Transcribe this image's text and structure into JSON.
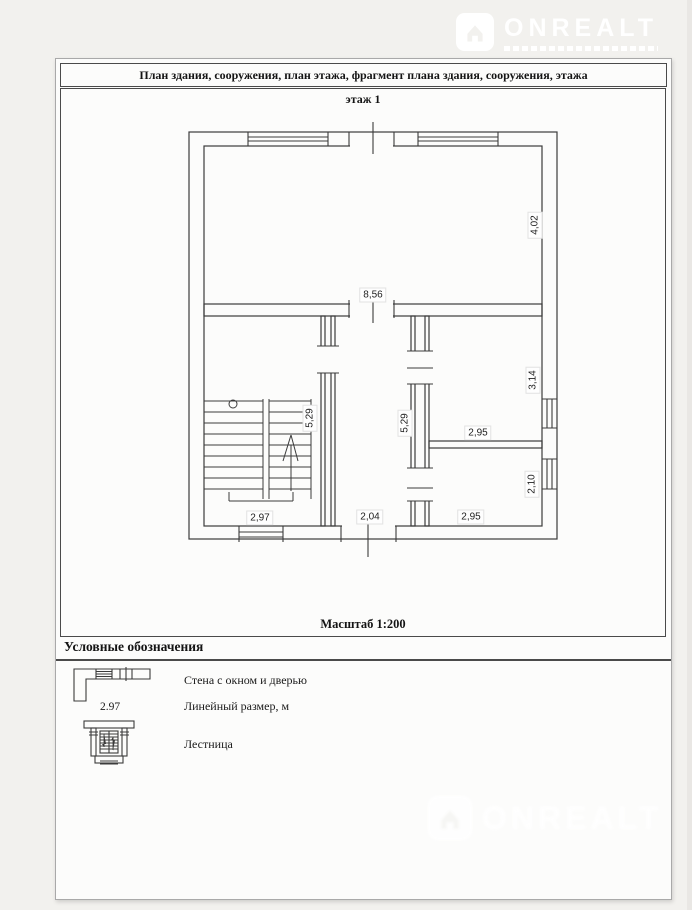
{
  "watermark": {
    "brand": "ONREALT",
    "color": "#ffffff"
  },
  "document": {
    "title": "План здания, сооружения, план этажа, фрагмент плана здания, сооружения, этажа",
    "floor_label": "этаж 1",
    "scale_label": "Масштаб 1:200"
  },
  "plan": {
    "dimensions": [
      "8,56",
      "4,02",
      "5,29",
      "5,29",
      "2,95",
      "3,14",
      "2,95",
      "2,10",
      "2,97",
      "2,04"
    ],
    "line_color": "#3b3b3b"
  },
  "legend": {
    "heading": "Условные обозначения",
    "items": [
      {
        "symbol": "wall-with-window-and-door",
        "label": "Стена с окном и дверью"
      },
      {
        "symbol": "linear-dimension",
        "sample": "2.97",
        "label": "Линейный размер, м"
      },
      {
        "symbol": "stairs",
        "label": "Лестница"
      }
    ]
  },
  "colors": {
    "page_background": "#fcfcfb",
    "outer_background": "#f2f1ee",
    "drawing_lines": "#3b3b3b"
  }
}
